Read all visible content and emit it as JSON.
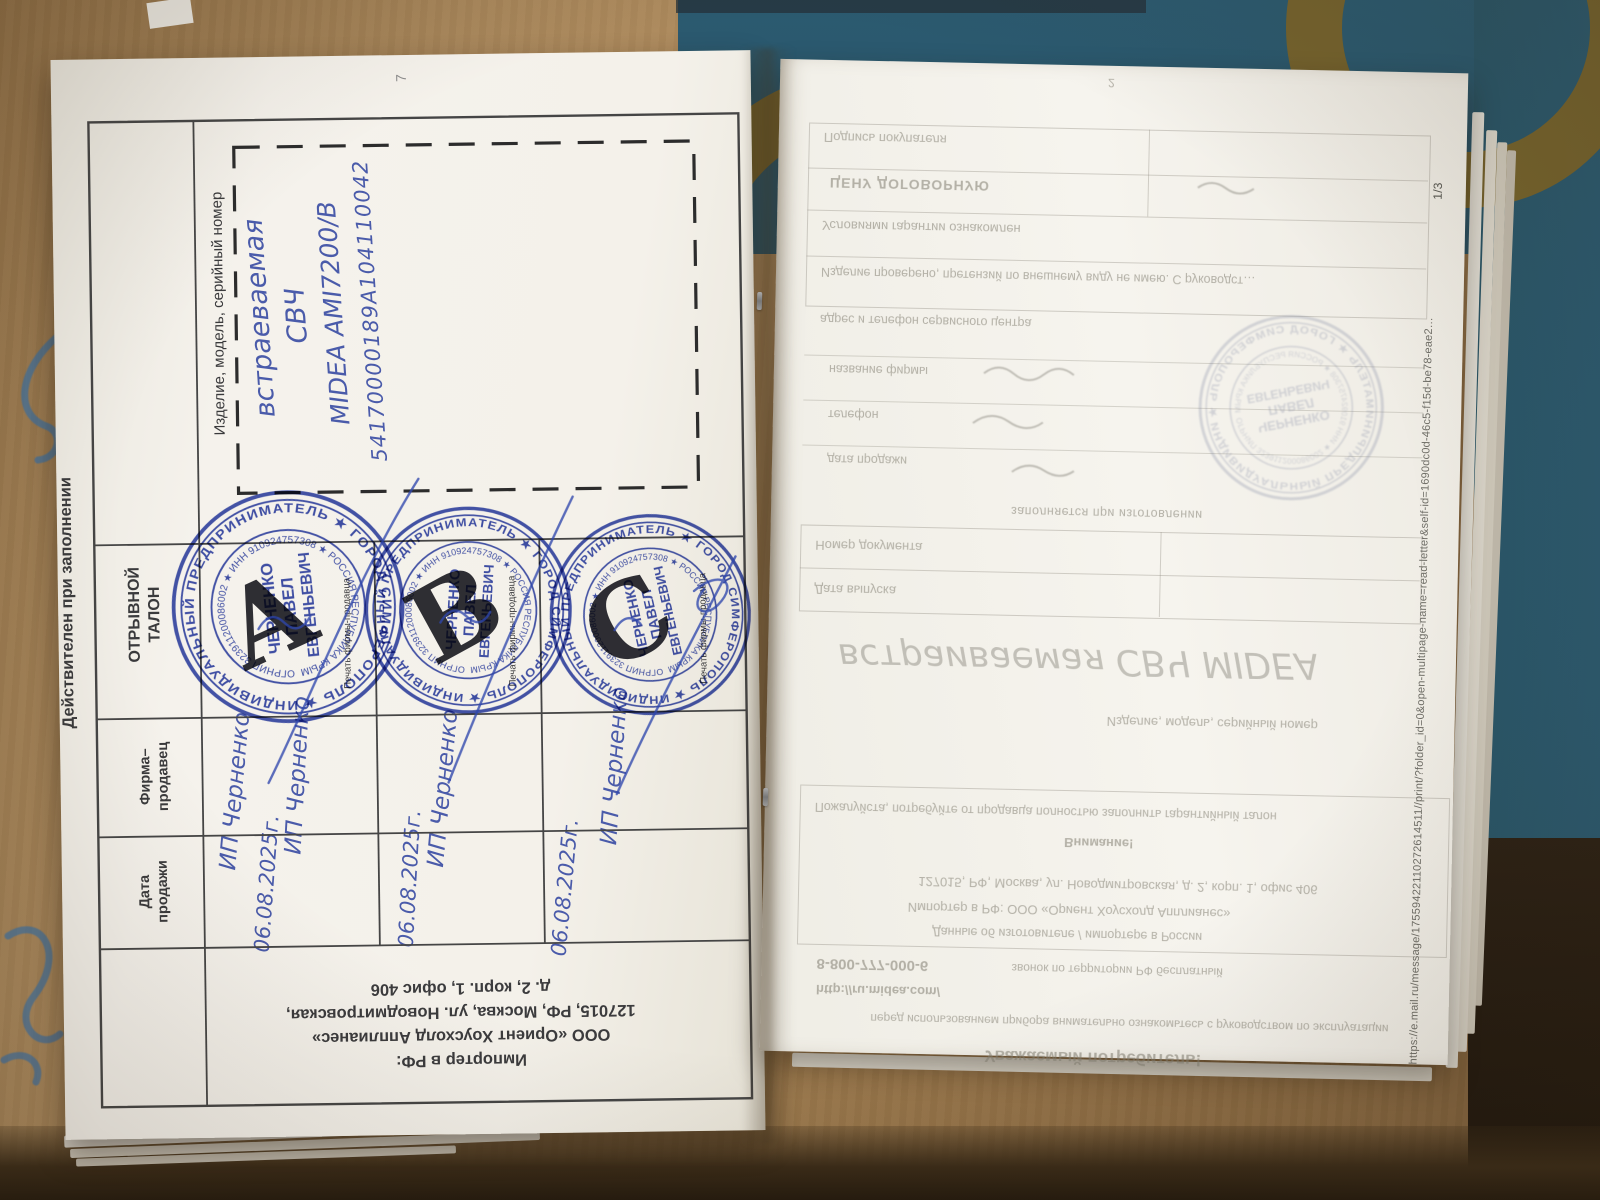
{
  "colors": {
    "stamp_blue": "#2c3fa8",
    "ink_blue": "#3c4fa5",
    "paper": "#f4f1ea",
    "cardboard": "#a27f54",
    "box_teal": "#2b5a70",
    "box_olive": "#7c6428",
    "dark_gap": "#241b12"
  },
  "left_page": {
    "page_number": "7",
    "margin_note": "Действителен при заполнении",
    "row_labels": {
      "product": "Изделие, модель, серийный номер",
      "coupon": [
        "ОТРЫВНОЙ",
        "ТАЛОН"
      ],
      "seller": [
        "Фирма–",
        "продавец"
      ],
      "date": [
        "Дата",
        "продажи"
      ]
    },
    "product_entry": [
      "встраеваемая",
      "СВЧ",
      "MIDEA AMI7200/B",
      "54170000189A104110042"
    ],
    "seal_caption": "Печать фирмы-продавца",
    "stamp": {
      "outer_ring": "ИНДИВИДУАЛЬНЫЙ ПРЕДПРИНИМАТЕЛЬ ★ ГОРОД СИМФЕРОПОЛЬ ★",
      "inner_ring": "ОГРНИП 323911200086002 ★ ИНН 910924757308 ★ РОССИЯ РЕСПУБЛИКА КРЫМ",
      "name": [
        "ЧЕРНЕНКО",
        "ПАВЕЛ",
        "ЕВГЕНЬЕВИЧ"
      ]
    },
    "coupons": [
      {
        "letter": "A",
        "seller": "ИП Черненко",
        "seller2": "ИП Черненко",
        "date": "06.08.2025г."
      },
      {
        "letter": "B",
        "seller": "ИП Черненко",
        "date": "06.08.2025г."
      },
      {
        "letter": "C",
        "seller": "ИП Черненко",
        "date": "06.08.2025г."
      }
    ],
    "importer": [
      "Импортер в РФ:",
      "ООО «Ориент Хоусхолд Апплианес»",
      "127015, РФ, Москва, ул. Новодмитровская,",
      "д. 2, корп. 1, офис 406"
    ]
  },
  "right_page": {
    "page_number": "2",
    "page_indicator": "1/3",
    "footer_url": "https://e.mail.ru/message/17559422110272614511//print/?folder_id=0&open-multipage-name=read-letter&self-id=1690dc0d-46c5-f15d-be78-eae2…",
    "faint": {
      "purchase_rows": [
        "Подпись покупателя",
        "ЦЕНУ ДОГОВОРНУЮ",
        "Условиями гарантии ознакомлен",
        "Изделие проверено, претензий по внешнему виду не имею. С руководст…"
      ],
      "service_line": "адрес и телефон сервисного центра",
      "seller_rows": [
        "название фирмы",
        "телефон",
        "дата продажи"
      ],
      "made_note": "заполняется при изготовлении",
      "doc_rows": [
        "Номер документа",
        "Дата выпуска"
      ],
      "big_handwriting": "встраиваемая СВЧ MIDEA",
      "product_label": "Изделие, модель, серийный номер",
      "notice_line": "Пожалуйста, потребуйте от продавца полностью заполнить гарантийный талон",
      "notice_title": "Внимание!",
      "address_line": "127015, РФ, Москва, ул. Новодмитровская, д. 2, корп. 1, офис 406",
      "importer_line": "Импортер в РФ: ООО «Ориент Хоусхолд Апплианес»",
      "data_line": "Данные об изготовителе / импортере в России",
      "hotline": "8-800-777-000-6",
      "hotline_note": "звонок по территории РФ бесплатный",
      "site": "http://ru.midea.com/",
      "manual_line": "перед использованием прибора внимательно ознакомьтесь с руководством по эксплуатации",
      "greeting": "Уважаемый потребитель!"
    }
  }
}
